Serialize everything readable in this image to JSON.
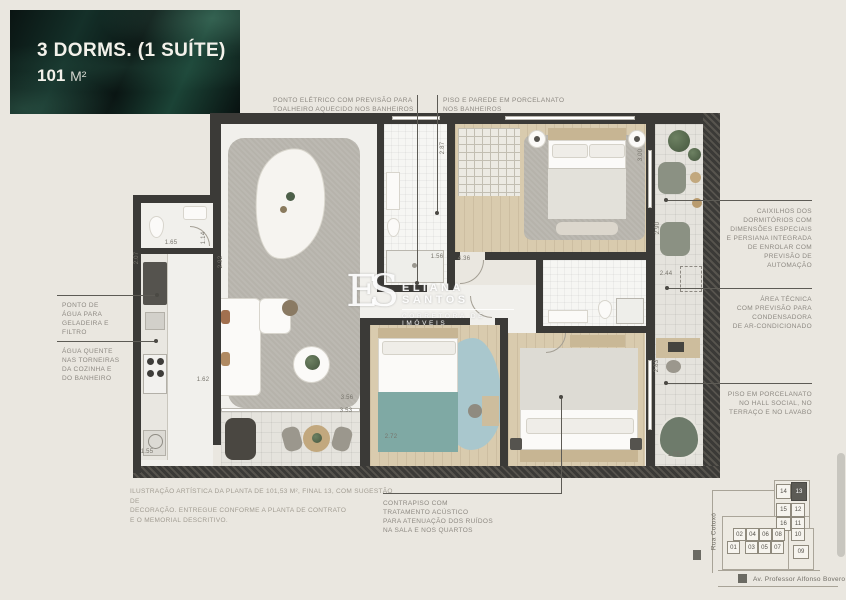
{
  "title_card": {
    "line1": "3 DORMS. (1 SUÍTE)",
    "area_value": "101",
    "area_unit": "M²"
  },
  "annotations": [
    {
      "id": "ponto-eletrico",
      "text": "PONTO ELÉTRICO COM PREVISÃO PARA\nTOALHEIRO AQUECIDO NOS BANHEIROS"
    },
    {
      "id": "piso-parede",
      "text": "PISO E PAREDE EM PORCELANATO\nNOS BANHEIROS"
    },
    {
      "id": "caixilhos",
      "text": "CAIXILHOS DOS\nDORMITÓRIOS COM\nDIMENSÕES ESPECIAIS\nE PERSIANA INTEGRADA\nDE ENROLAR COM\nPREVISÃO DE\nAUTOMAÇÃO"
    },
    {
      "id": "area-tecnica",
      "text": "ÁREA TÉCNICA\nCOM PREVISÃO PARA\nCONDENSADORA\nDE AR-CONDICIONADO"
    },
    {
      "id": "piso-porcelanato",
      "text": "PISO EM PORCELANATO\nNO HALL SOCIAL, NO\nTERRAÇO E NO LAVABO"
    },
    {
      "id": "ponto-agua",
      "text": "PONTO DE\nÁGUA PARA\nGELADEIRA E\nFILTRO"
    },
    {
      "id": "agua-quente",
      "text": "ÁGUA QUENTE\nNAS TORNEIRAS\nDA COZINHA E\nDO BANHEIRO"
    },
    {
      "id": "contrapiso",
      "text": "CONTRAPISO COM\nTRATAMENTO ACÚSTICO\nPARA ATENUAÇÃO DOS RUÍDOS\nNA SALA E NOS QUARTOS"
    }
  ],
  "watermark": {
    "monogram": "ES",
    "name": "ELIANA SANTOS",
    "subtitle": "CORRETORA DE IMÓVEIS"
  },
  "disclaimer": "ILUSTRAÇÃO ARTÍSTICA DA PLANTA DE 101,53 M², FINAL 13, COM SUGESTÃO DE\nDECORAÇÃO. ENTREGUE CONFORME A PLANTA DE CONTRATO\nE O MEMORIAL DESCRITIVO.",
  "dimensions": [
    {
      "label": "2.87",
      "x": 443,
      "y": 148,
      "v": true
    },
    {
      "label": "2.92",
      "x": 221,
      "y": 262,
      "v": true
    },
    {
      "label": "1.65",
      "x": 171,
      "y": 243,
      "v": false
    },
    {
      "label": "1.14",
      "x": 204,
      "y": 238,
      "v": true
    },
    {
      "label": "2.07",
      "x": 137,
      "y": 258,
      "v": true
    },
    {
      "label": "1.62",
      "x": 203,
      "y": 380,
      "v": false
    },
    {
      "label": "1.55",
      "x": 147,
      "y": 452,
      "v": false
    },
    {
      "label": "3.56",
      "x": 347,
      "y": 398,
      "v": false
    },
    {
      "label": "3.53",
      "x": 346,
      "y": 411,
      "v": false
    },
    {
      "label": "2.72",
      "x": 391,
      "y": 437,
      "v": false
    },
    {
      "label": "1.56",
      "x": 437,
      "y": 257,
      "v": false
    },
    {
      "label": "4.36",
      "x": 464,
      "y": 259,
      "v": false
    },
    {
      "label": "3.00",
      "x": 641,
      "y": 155,
      "v": true
    },
    {
      "label": "2.90",
      "x": 658,
      "y": 228,
      "v": true
    },
    {
      "label": "2.44",
      "x": 666,
      "y": 274,
      "v": false
    },
    {
      "label": "2.83",
      "x": 657,
      "y": 366,
      "v": true
    },
    {
      "label": "1.05",
      "x": 674,
      "y": 455,
      "v": false
    }
  ],
  "key_map": {
    "street_vertical": "Rua Cotoxó",
    "street_horizontal": "Av. Professor Alfonso Bovero",
    "highlighted_unit": "13",
    "units": [
      {
        "n": "14",
        "x": 776,
        "y": 484,
        "w": 15,
        "h": 15
      },
      {
        "n": "13",
        "x": 791,
        "y": 482,
        "w": 16,
        "h": 19,
        "hl": true
      },
      {
        "n": "15",
        "x": 776,
        "y": 503,
        "w": 15,
        "h": 14
      },
      {
        "n": "12",
        "x": 791,
        "y": 503,
        "w": 14,
        "h": 14
      },
      {
        "n": "16",
        "x": 776,
        "y": 517,
        "w": 15,
        "h": 14
      },
      {
        "n": "11",
        "x": 791,
        "y": 517,
        "w": 14,
        "h": 14
      },
      {
        "n": "02",
        "x": 733,
        "y": 528,
        "w": 13,
        "h": 13
      },
      {
        "n": "04",
        "x": 746,
        "y": 528,
        "w": 13,
        "h": 13
      },
      {
        "n": "06",
        "x": 759,
        "y": 528,
        "w": 13,
        "h": 13
      },
      {
        "n": "08",
        "x": 772,
        "y": 528,
        "w": 13,
        "h": 13
      },
      {
        "n": "10",
        "x": 791,
        "y": 528,
        "w": 14,
        "h": 13
      },
      {
        "n": "01",
        "x": 727,
        "y": 541,
        "w": 13,
        "h": 13
      },
      {
        "n": "03",
        "x": 745,
        "y": 541,
        "w": 13,
        "h": 13
      },
      {
        "n": "05",
        "x": 758,
        "y": 541,
        "w": 13,
        "h": 13
      },
      {
        "n": "07",
        "x": 771,
        "y": 541,
        "w": 13,
        "h": 13
      },
      {
        "n": "09",
        "x": 793,
        "y": 545,
        "w": 16,
        "h": 14
      }
    ]
  },
  "colors": {
    "background": "#eae7e0",
    "title_bg": "#0b1513",
    "wall": "#3b3a37",
    "annotation_text": "#8d8982",
    "wood_floor": "#d9cbae",
    "rug": "#b6b3ab",
    "teal_accent": "#7fa9a4",
    "blue_rug": "#a9c7cd",
    "green_chair": "#6e7b6b",
    "map_highlight": "#5c5b55"
  }
}
